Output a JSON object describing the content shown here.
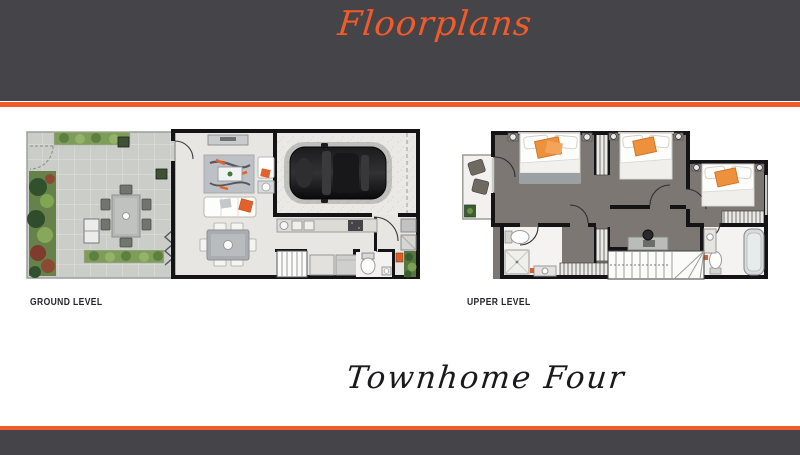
{
  "header": {
    "title": "Floorplans",
    "background": "#454449",
    "stripe_color": "#f15a29"
  },
  "plans": [
    {
      "id": "ground",
      "label": "GROUND LEVEL"
    },
    {
      "id": "upper",
      "label": "UPPER LEVEL"
    }
  ],
  "caption": "Townhome Four",
  "footer": {
    "stripe_color": "#f15a29",
    "background": "#454449"
  },
  "colors": {
    "accent_orange": "#f15a29",
    "banner_gray": "#454449",
    "furniture_orange": "#e2622b",
    "carpet_gray": "#7c7772",
    "paver_gray": "#cbcdc9",
    "interior_floor": "#e8e6e2",
    "wall_black": "#141416",
    "script_dark": "#1a1a1c"
  }
}
